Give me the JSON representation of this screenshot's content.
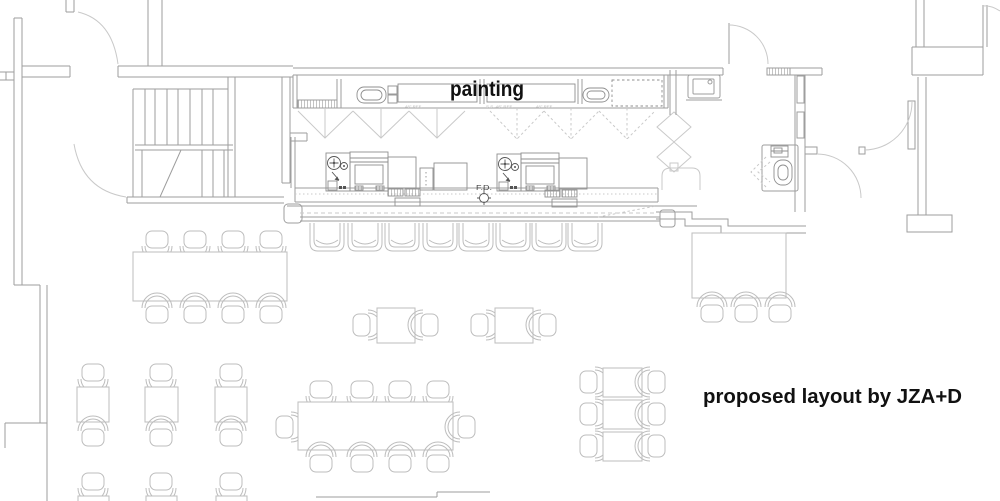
{
  "labels": {
    "painting": "painting",
    "attribution": "proposed layout by JZA+D",
    "floor_drain": "F.D.",
    "equipment_left": "48\" REF.",
    "equipment_center": "S.S. 48\" REF.",
    "equipment_right": "48\" REF."
  },
  "colors": {
    "background": "#ffffff",
    "wall": "#9e9e9e",
    "wall_light": "#c9c9c9",
    "furniture": "#bdbdbd",
    "equipment": "#8f8f8f",
    "detail": "#555555",
    "text": "#111111",
    "faint_text": "#b8b8b8"
  }
}
